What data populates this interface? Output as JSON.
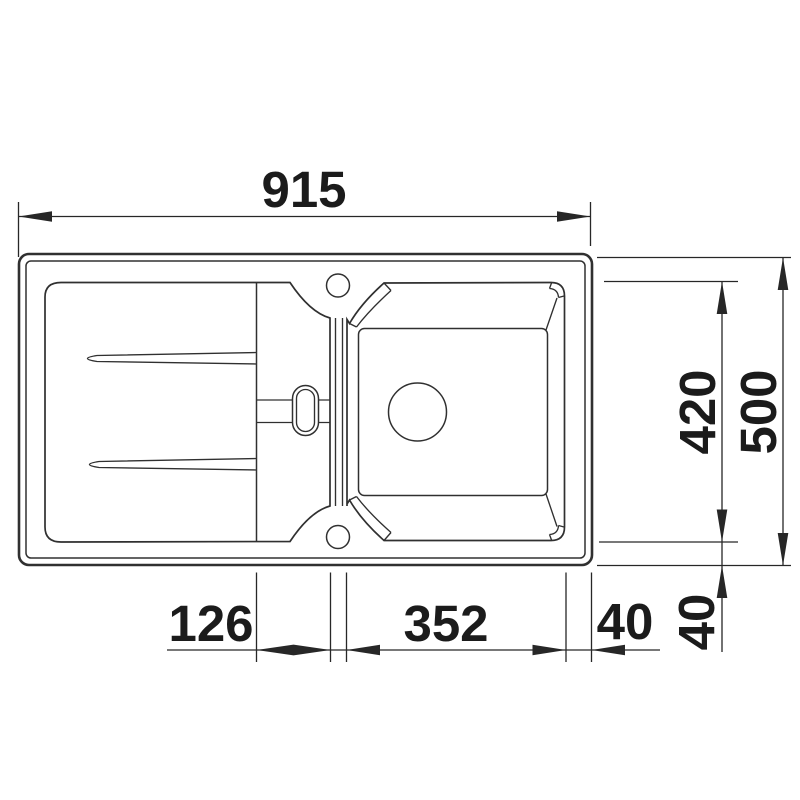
{
  "drawing": {
    "subject": "kitchen-sink-with-drainboard-top-view-dimension-drawing",
    "units": "mm",
    "dimensions": {
      "overall_width": "915",
      "overall_depth": "500",
      "bowl_depth": "420",
      "drainer_step_width": "126",
      "bowl_width": "352",
      "bowl_offset_right": "40",
      "bowl_offset_bottom": "40"
    },
    "colors": {
      "line": "#303030",
      "dimension_line": "#272727",
      "text": "#1b1b1b",
      "background": "#ffffff"
    }
  }
}
